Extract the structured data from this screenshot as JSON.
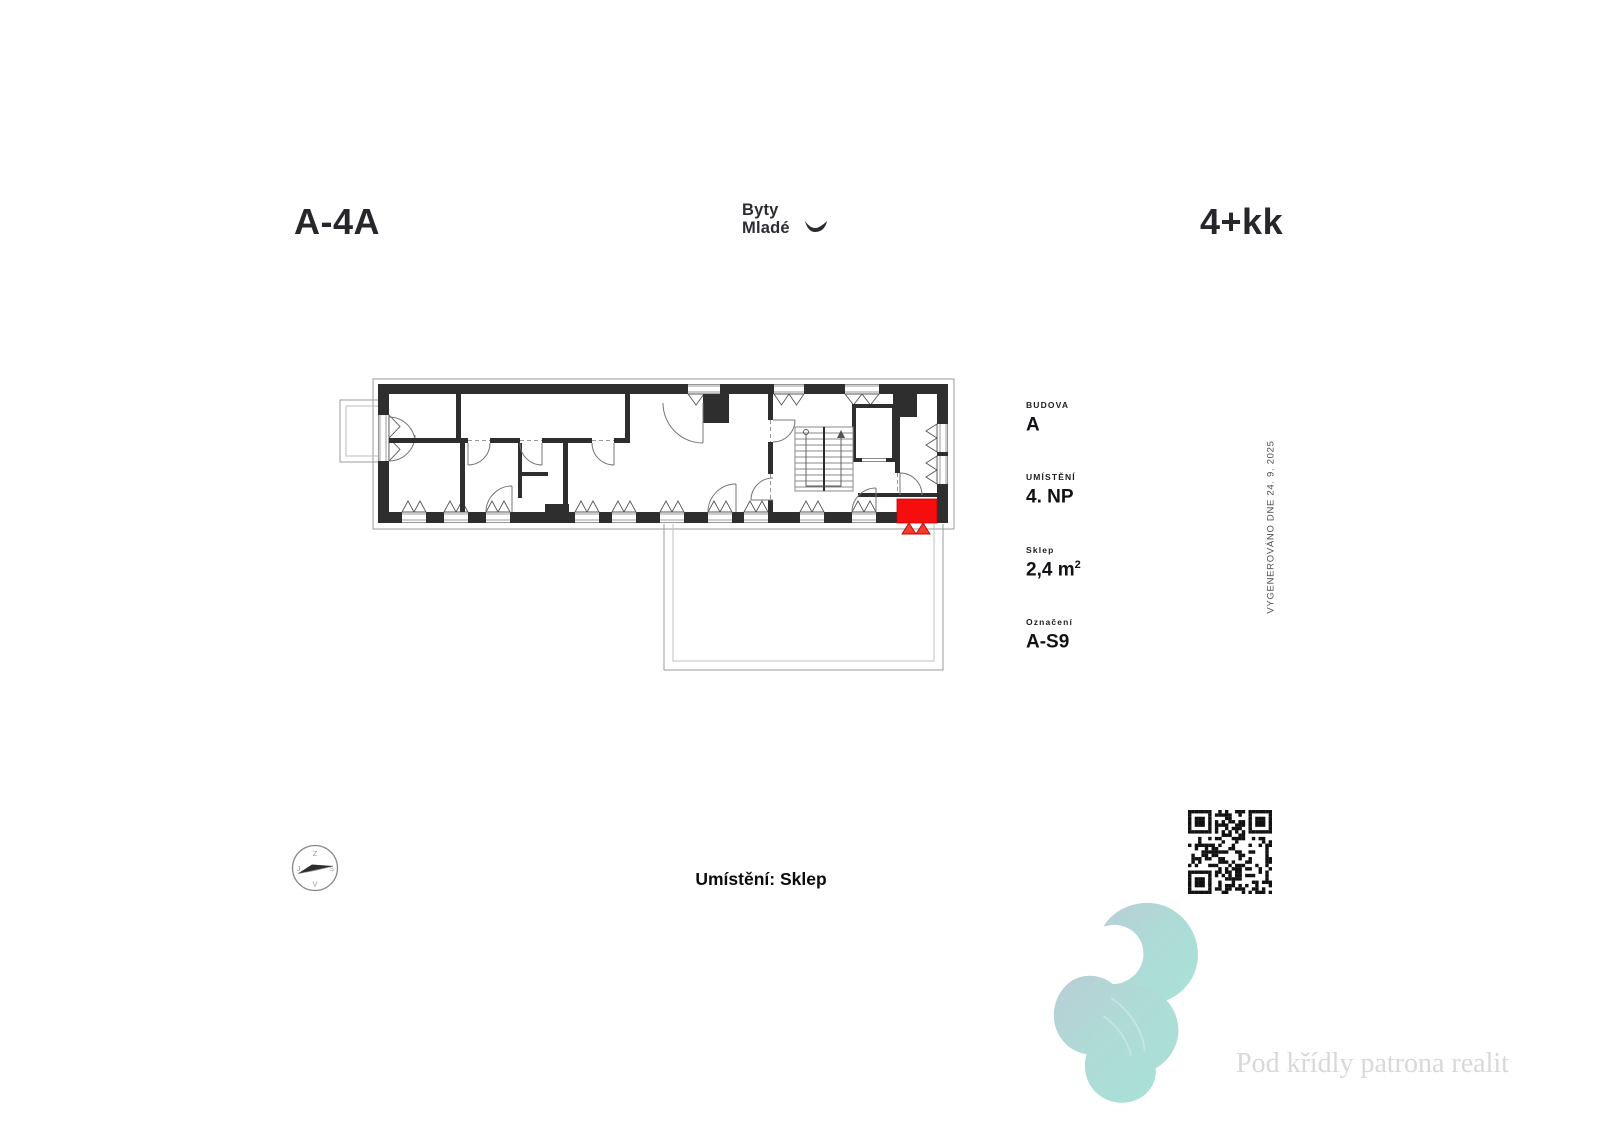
{
  "page": {
    "unit_code": "A-4A",
    "disposition": "4+kk",
    "brand": {
      "line1": "Byty",
      "line2": "Mladé"
    },
    "generated_note": "VYGENEROVÁNO DNE 24. 9. 2025",
    "location_caption": "Umístění: Sklep",
    "tagline": "Pod křídly patrona realit"
  },
  "info_panel": {
    "items": [
      {
        "label": "BUDOVA",
        "value": "A"
      },
      {
        "label": "UMÍSTĚNÍ",
        "value": "4. NP"
      },
      {
        "label": "Sklep",
        "value": "2,4 m",
        "sup": "2"
      },
      {
        "label": "Označení",
        "value": "A-S9"
      }
    ]
  },
  "compass": {
    "top": "Z",
    "right": "S",
    "bottom": "V",
    "left": "J"
  },
  "floor_plan": {
    "highlighted_unit": "A-S9",
    "highlight_color": "#f60d0d"
  }
}
